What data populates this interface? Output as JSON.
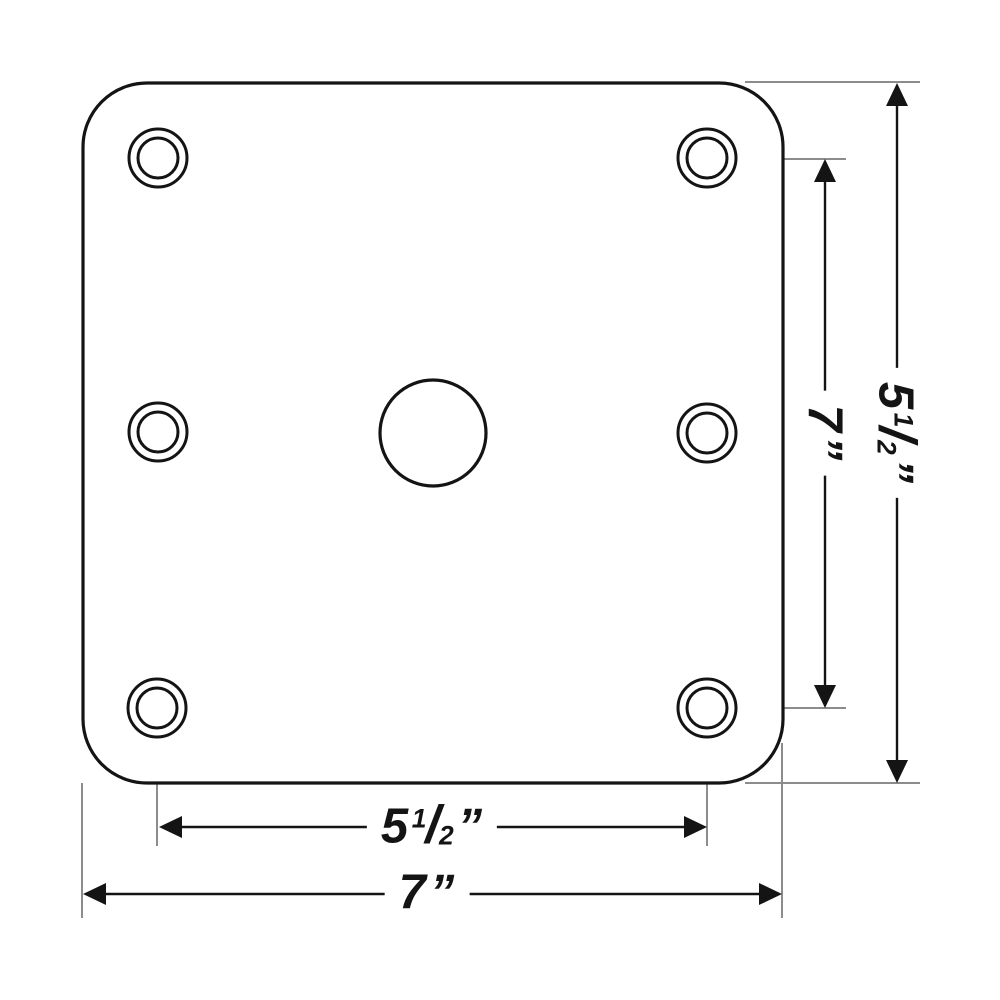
{
  "diagram": {
    "background_color": "#ffffff",
    "ink_color": "#141414",
    "extension_line_color": "#8c8c8c",
    "description": "dimension-drawing-of-square-mounting-plate",
    "labels": {
      "dim_bottom_inner": {
        "whole": "5",
        "numerator": "1",
        "slash": "/",
        "denominator": "2",
        "unit": "”"
      },
      "dim_bottom_outer": {
        "whole": "7",
        "unit": "”"
      },
      "dim_right_inner": {
        "whole": "7",
        "unit": "”"
      },
      "dim_right_outer": {
        "whole": "5",
        "numerator": "1",
        "slash": "/",
        "denominator": "2",
        "unit": "”"
      }
    }
  }
}
